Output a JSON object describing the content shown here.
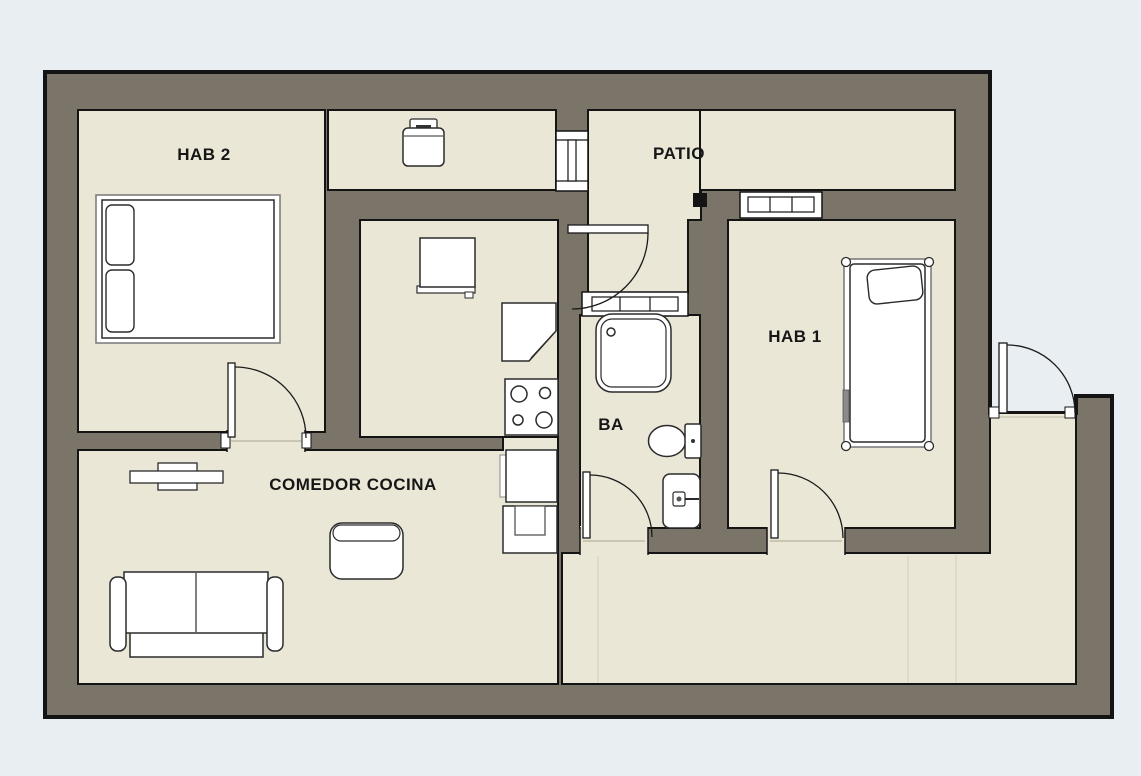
{
  "plan": {
    "title": "apartment-floor-plan",
    "rooms": [
      {
        "id": "hab2",
        "label": "HAB 2"
      },
      {
        "id": "patio",
        "label": "PATIO"
      },
      {
        "id": "hab1",
        "label": "HAB 1"
      },
      {
        "id": "ba",
        "label": "BA"
      },
      {
        "id": "comedor",
        "label": "COMEDOR COCINA"
      }
    ],
    "colors": {
      "background": "#e8eef1",
      "wall": "#7b7468",
      "floor": "#ebe7d7",
      "outline": "#141414",
      "furniture": "#ffffff"
    },
    "furniture": [
      "double-bed",
      "washing-machine",
      "fridge-counter",
      "corner-counter",
      "stove",
      "kitchen-counter",
      "kitchen-sink",
      "dining-table",
      "armchair",
      "sofa",
      "single-bed",
      "shower",
      "toilet",
      "bathroom-sink"
    ],
    "openings": [
      "hab2-door",
      "patio-door",
      "ba-door",
      "hab1-door",
      "entry-door",
      "window-laundry-patio",
      "window-patio-hab1",
      "window-vestibule-ba"
    ]
  }
}
